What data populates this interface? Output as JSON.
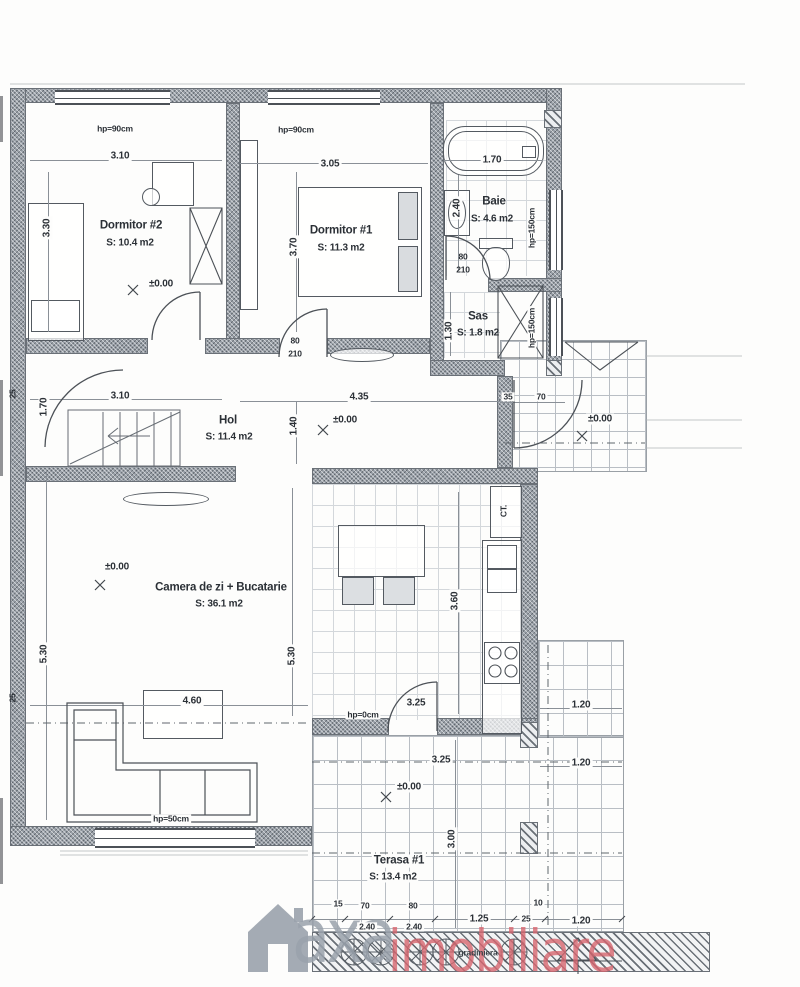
{
  "watermark": {
    "brand_primary": "axa",
    "brand_secondary": "imobiliare"
  },
  "rooms": {
    "dormitor2": {
      "name": "Dormitor #2",
      "area": "S: 10.4 m2"
    },
    "dormitor1": {
      "name": "Dormitor #1",
      "area": "S: 11.3 m2"
    },
    "baie": {
      "name": "Baie",
      "area": "S: 4.6 m2"
    },
    "sas": {
      "name": "Sas",
      "area": "S: 1.8 m2"
    },
    "hol": {
      "name": "Hol",
      "area": "S: 11.4 m2"
    },
    "living": {
      "name": "Camera de zi + Bucatarie",
      "area": "S: 36.1 m2"
    },
    "terasa": {
      "name": "Terasa #1",
      "area": "S: 13.4 m2"
    },
    "boiler": "CT."
  },
  "levels": {
    "zero": "±0.00"
  },
  "parapets": {
    "h90": "hp=90cm",
    "h150": "hp=150cm",
    "h50": "hp=50cm",
    "h0": "hp=0cm"
  },
  "dims": {
    "w310": "3.10",
    "w330": "3.30",
    "w305": "3.05",
    "w370": "3.70",
    "w170": "1.70",
    "w240": "2.40",
    "w130": "1.30",
    "w435": "4.35",
    "w140": "1.40",
    "w530": "5.30",
    "w460": "4.60",
    "w360": "3.60",
    "w325": "3.25",
    "w300": "3.00",
    "w120": "1.20",
    "t15": "15",
    "t70": "70",
    "t80": "80",
    "t125": "1.25",
    "t10": "10",
    "t25": "25",
    "t35": "35",
    "t210": "210"
  },
  "annotations": {
    "gradiniera": "gradiniera"
  },
  "palette": {
    "wall": "#99a0a8",
    "line": "#4c5157",
    "brand_gray": "#9aa2ac",
    "brand_red": "#d7666f"
  }
}
